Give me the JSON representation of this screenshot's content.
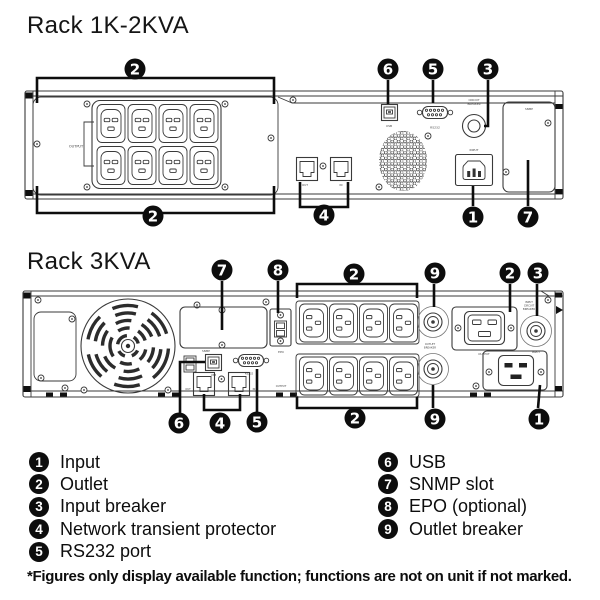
{
  "page": {
    "bg": "#ffffff",
    "ink": "#0d0d0d"
  },
  "rack1": {
    "title": "Rack 1K-2KVA",
    "callouts": {
      "outlet_top": "2",
      "outlet_bottom": "2",
      "usb": "6",
      "rs232": "5",
      "breaker": "3",
      "network": "4",
      "input": "1",
      "snmp": "7"
    },
    "labels": {
      "output": "OUTPUT",
      "usb": "USB",
      "rs232": "RS232",
      "cb1": "CIRCUIT",
      "cb2": "BREAKER",
      "input": "INPUT",
      "snmp": "SNMP",
      "net_out": "OUT",
      "net_in": "IN"
    }
  },
  "rack2": {
    "title": "Rack 3KVA",
    "callouts": {
      "snmp": "7",
      "epo": "8",
      "outlet_top": "2",
      "breaker_top": "9",
      "c19": "2",
      "input_breaker": "3",
      "usb": "6",
      "network": "4",
      "rs232": "5",
      "outlet_bottom": "2",
      "breaker_bottom": "9",
      "input": "1"
    },
    "labels": {
      "snmp": "SNMP",
      "epo": "EPO",
      "usb": "USB",
      "rs232": "RS232",
      "net_out": "OUT",
      "net_in": "IN",
      "output_side": "OUTPUT",
      "ob1": "OUTLET",
      "ob2": "BREAKER",
      "c19_output": "OUTPUT",
      "ib1": "INPUT",
      "ib2": "CIRCUIT",
      "ib3": "BREAKER",
      "input": "INPUT"
    }
  },
  "legend": {
    "items": [
      {
        "num": "1",
        "label": "Input"
      },
      {
        "num": "2",
        "label": "Outlet"
      },
      {
        "num": "3",
        "label": "Input breaker"
      },
      {
        "num": "4",
        "label": "Network transient protector"
      },
      {
        "num": "5",
        "label": "RS232 port"
      },
      {
        "num": "6",
        "label": "USB"
      },
      {
        "num": "7",
        "label": "SNMP slot"
      },
      {
        "num": "8",
        "label": "EPO (optional)"
      },
      {
        "num": "9",
        "label": "Outlet breaker"
      }
    ]
  },
  "footer": {
    "note": "*Figures only display available function; functions are not on unit if not marked."
  }
}
